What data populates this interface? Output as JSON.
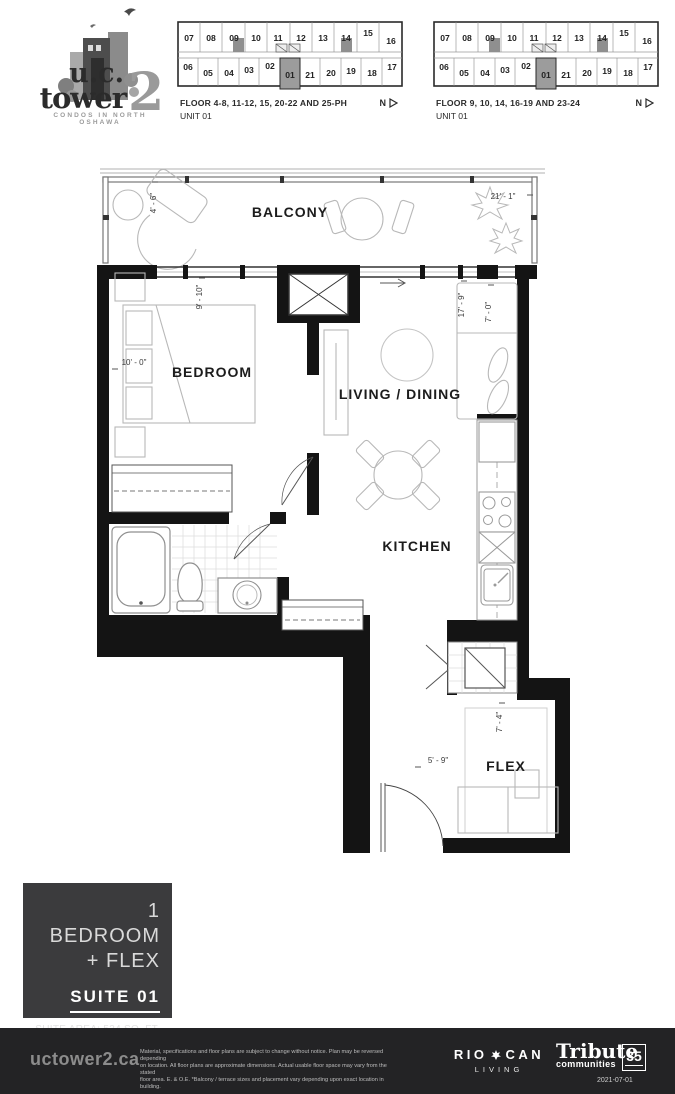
{
  "logo": {
    "line1": "u.c.",
    "line2": "tower",
    "number": "2",
    "tagline": "CONDOS IN NORTH OSHAWA"
  },
  "keyplans": [
    {
      "caption_line1": "FLOOR 4-8, 11-12, 15, 20-22 AND 25-PH",
      "caption_line2": "UNIT 01",
      "north_label": "N",
      "highlighted_unit": "01",
      "units_top": [
        "07",
        "08",
        "09",
        "10",
        "11",
        "12",
        "13",
        "14",
        "15",
        "16"
      ],
      "units_bottom": [
        "06",
        "05",
        "04",
        "03",
        "02",
        "01",
        "21",
        "20",
        "19",
        "18",
        "17"
      ]
    },
    {
      "caption_line1": "FLOOR 9, 10, 14, 16-19 AND 23-24",
      "caption_line2": "UNIT 01",
      "north_label": "N",
      "highlighted_unit": "01",
      "units_top": [
        "07",
        "08",
        "09",
        "10",
        "11",
        "12",
        "13",
        "14",
        "15",
        "16"
      ],
      "units_bottom": [
        "06",
        "05",
        "04",
        "03",
        "02",
        "01",
        "21",
        "20",
        "19",
        "18",
        "17"
      ]
    }
  ],
  "floorplan": {
    "rooms": {
      "balcony": "BALCONY",
      "bedroom": "BEDROOM",
      "living": "LIVING / DINING",
      "kitchen": "KITCHEN",
      "flex": "FLEX"
    },
    "dimensions": {
      "balcony_depth": "4' - 6\"",
      "balcony_width": "21' - 1\"",
      "bedroom_width": "9' - 10\"",
      "bedroom_depth": "10' - 0\"",
      "living_length": "17' - 9\"",
      "living_width": "7' - 0\"",
      "flex_width": "5' - 9\"",
      "flex_depth": "7' - 4\""
    }
  },
  "info_panel": {
    "title_line1": "1 BEDROOM",
    "title_line2": "+ FLEX",
    "suite_label": "SUITE 01",
    "suite_area": "SUITE AREA: 534 SQ. FT.",
    "balcony_area": "BALCONY: 105 SQ. FT."
  },
  "footer": {
    "website": "uctower2.ca",
    "disclaimer_line1": "Material, specifications and floor plans are subject to change without notice.  Plan may be reversed depending",
    "disclaimer_line2": "on location. All floor plans are approximate dimensions. Actual usable floor space may vary from the stated",
    "disclaimer_line3": "floor area.  E. & O.E.  *Balcony / terrace sizes and placement vary depending upon exact location in building.",
    "riocan_part1": "RIO",
    "riocan_part2": "CAN",
    "riocan_sub": "LIVING",
    "tribute_line1": "Tribute",
    "tribute_line2": "communities",
    "tribute_badge": "35",
    "date": "2021-07-01"
  }
}
